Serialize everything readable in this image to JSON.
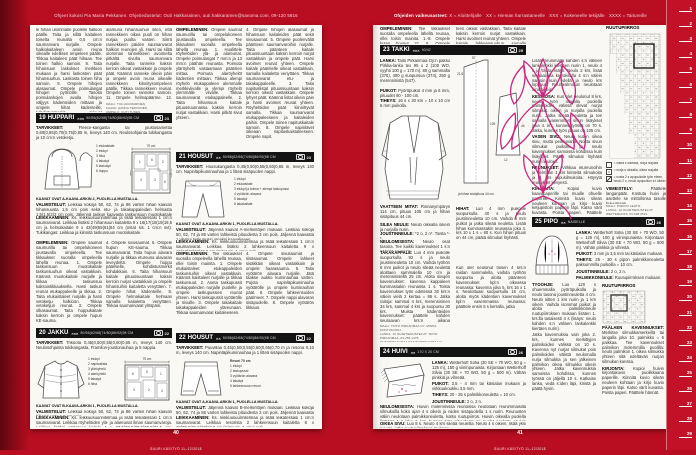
{
  "colors": {
    "bg": "#b90e21",
    "bar_bg": "#141414",
    "motif_pink": "#c9277e",
    "page": "#faf8f4"
  },
  "header_left": "Ohjeet kokosi Pia Maria Pekkanen. Ohjetiedustelut: Outi Hakkarainen, outi.hakkarainen@sanoma.com, 09-120 5816",
  "header_right": {
    "prefix": "Ohjeiden vaikeusasteet:",
    "levels": [
      "X = Aloittelijalle",
      "XX = Hieman harrastaneelle",
      "XXX = Kokeneelle tekijälle",
      "XXXX = Taitureille"
    ]
  },
  "footer": {
    "left_num": "40",
    "right_num": "41",
    "magazine": "SUURI KÄSITYÖ 11–12/2018"
  },
  "ruler": {
    "unit_numbers": [
      "1",
      "2",
      "3",
      "4",
      "5",
      "6",
      "7",
      "8",
      "9",
      "10",
      "11",
      "12",
      "13",
      "14",
      "15",
      "16",
      "17",
      "18",
      "19",
      "20",
      "21",
      "22",
      "23",
      "24",
      "25",
      "26",
      "27",
      "28",
      "29"
    ]
  },
  "lp": {
    "tail": {
      "c1": "le hihan ulommalle puolelle halkion päälle. Taita ja silitä kaitaleen toiselta reunalta 0,5 cm:n saumanvara nurjalle. Ompele halkiokaitaleen avoin reuna oikealle edellisen ompeleen päälle. Tikkaa kaitaleen päät hihaan. Tee toinen halkio samoin. 8. Taita hihansuun laskokset merkkien mukaan ja harsi laskosten päät hihansuuhun. Laskosta toinen hiha samoin. 9. Ompele hihojen alasaumat. Ompele poimulangat hihojen pyöriöille. Tasoita poimulankojen avulla hihojen väljyys kädenteiden mittaan ja ompele hihat kädenteille, kohdistusmerkit tulevat kohdakkain. 10. Ompele sisempi ja alempi ranneke ylämunoista yhteen. Ompele sisemmän rannekkeen",
      "c2": "alareuna hihansuuhun siten, että rannekkeen oikea puoli on hihan nurjaa puolta vasten. Siirrä rannekkeen päiden saumanvarat halkion reunojen yli. Harsi tai silitä ulomman rannekkeen avoimelta pitkältä sivulta saumanvara nurjalle. Taita ranneke kaksin kerroin oikeat vastakkain ja ompele päät. Käännä ranneke oikein päin ja ompele avoin reuna oikealle rannekkeen kiinnitysompeleen päälle. Tikkaa rannekkeen reunat. Ompele toinen ranneke samoin. 11. Ompele helmapäärme. 12. Ompele napinlävet ja napit etuosaan, hihanhalkioihin ja rannekkeisiin.",
      "credits": [
        "MALLI: TIIA HUUMARINEN",
        "KAAVA: HANNA TERVONEN",
        "OMPELU: OUTI TUNEN"
      ],
      "c3_h": "OMPELEMINEN:",
      "c3": "Ompele saumat saumurilla tai ompelukoneen joustavalla ompeleella. Tee tikkaukset suoralla ompeleella lähellä reunaa. 1. Huolittele röyhelöiden ylä- ja alareunat. Ompele poimulangat 7 mm:n ja 13 mm:n päähän reunasta. Poimuta yläröyhelö vastaamaan pääntien mittaa. Poimuta alaröyhelöt kädentien mittaan. Tikkaa alempi röyhelö etukappaleen alemmalle merkkiviivalle ja ylempi röyhelö ylemmälle viivalle. Tikkaa saumanvarat etukappaleelle. 2. Taita hihansuun kaitale pituussuunnassa kaksin kerroin nurjat vastakkain. Harsi pitkät sivut yhteen.",
      "c4": "4. Ompele hihojen alasaumat ja hihansuun kaitaleiden päät sekä sivusaumat. 5. Ompele puolenväliä päänteen saumanvaroihin nurjalle. Taita päänteen kaitale pituussuuntaan kaksin kerroin nurjat vastakkain ja ompele päät. Harsi avoimet reunat yhteen. Ompele kaitale pääntielle oikeat vastakkain, samalla kaitaletta venyttäen. Tikkaa saumanvarat etu- ja takakappaleelle. 3. Taita napituslistat pituussuuntaan kaksin kerroin oikeat vastakkain. Ompele lyhyet päät. Käännä listat oikein päin ja harsi avoimet reunat yhteen. Röyhelöiden päät kiinnittyvät samalla. Tikkaa saumanvarat etukappaleeseen ja kaitaleiden päihin. Ompele toinen napituskaitale samoin. 8. Ompele napinlävet oikeaan napituskaistaleeseen. Ompele napit."
    },
    "p19": {
      "num": "19",
      "name": "HUPPARI",
      "stars": "×××",
      "sizes": "50/56(62/68(74/80(86/92(98 CM",
      "photo": "23",
      "tarv_h": "TARVIKKEET:",
      "tarv": "Fleece-kangasta tai joustosamettia 0,60(0,65(0,70(0,75(0,85 m, leveys 140 cm. Neulosohjainta tukikangasta ja 10 cm:n vetoketju.",
      "pieces": [
        "1 etukaistale",
        "2 etukpl",
        "3 hiha",
        "4 takakpl",
        "5 taskukpl",
        "6 huppu"
      ],
      "layout_label": "70 cm",
      "layout_nums": [
        "1",
        "5",
        "2",
        "4",
        "3",
        "6"
      ],
      "fabric": "kangas",
      "fold": "taite",
      "kaavat": "KAAVAT OVAT A-KAAVA-ARKIN 2, PUOLELLA MUSTALLA.",
      "valm_h": "VALMISTELUT:",
      "valm": "Leikkaa kokoja 50, 62, 74 ja 86 varten hihan kaavan hihansuusta 1,5 cm pois sekä etu- ja takakappaleiden helmasta 1,5(1,5(2(2 cm pois. Jäljennä taskun kaavasta taskunsuun muotokaitale omaksi kaavakseen.",
      "leik_h": "LEIKKAAMINEN:",
      "leik": "Ks. leikkuusuunnitelmaa ja lisää leikatessasi 1 cm:n saumanvarat. Leikkaa lisäksi 2 hihansuun kaitaletta 9 x 16(17(18(19(19,5 cm ja helmakaitale 9 x 43(49(55(61(64 cm (mitat sis. 1 cm:n svt). Tukikangas: Leikkaa ja kiinnitä taskunsuun muotokaitale.",
      "omp_h": "OMPELEMINEN:",
      "omp1": "Ompele saumat saumurilla tai ompelukoneen joustavalla ompeleella. Tee tikkaukset suoralla ompeleella lähellä reunaa. 1. Ompele taskunsuun muotokaitale taskunsuuhun oikeat vastakkain. Käännä muotokaitale nurjalle ja tikkaa taskunsuu kaksoistikkauksella. Harsi taskun reunat etukappaleelle ja tikkaa. 2. Taita etukaistaleet nurjalle ja harsi vetoketju halkioon. Tikkaa vetoketjun reunat. 3. Ompele olkasaumat. Taita huppukaitale kaksin kerroin ja ompele hupun KE-sauma.",
      "omp2": "4. Ompele sivusaumat. 5. Ompele hupun KE-sauma. Tikkaa saumanvarat. Taita hupun alavara nurjalle ja tikkaa etureuna alavaran leveydeltä. Ompele huppu pääntielle, kohdistusmerkit kohdakkain. 6. Taita hihansuun kaitale pituussuuntaan kaksin kerroin nurjat vastakkain ja ompele hihansuihin kaitaletta venyttäen. 7. Ompele hihat kädenteille. 8. Ompele helmakaitale helmaan samalla kaitaletta venyttäen. Tikkaa saumanvarat ylöspäin."
    },
    "p20": {
      "num": "20",
      "name": "JAKKU",
      "stars": "×××",
      "sizes": "50/56(62/68(74/80(86/92(98 CM",
      "photo": "22",
      "tarv_h": "TARVIKKEET:",
      "tarv": "Trikoota 0,45(0,50(0,55(0,60(0,65 m, leveys 140 cm. Neulosohjainta tukikangasta, Framilon-joustonauhaa ja 5 nappia.",
      "pieces": [
        "1 etukpl",
        "2 napituslista",
        "3 yläröyhelö",
        "4 alaröyhelö",
        "5 takakpl",
        "6 hiha"
      ],
      "layout_label": "70 cm",
      "layout_nums": [
        "6",
        "5",
        "1",
        "3",
        "2",
        "4"
      ],
      "kaavat": "KAAVAT OVAT B-KAAVA-ARKIN 1, PUOLELLA MUSTALLA.",
      "valm_h": "VALMISTELUT:",
      "valm": "Leikkaa kokoja 50, 62, 74 ja 86 varten hihan kaavan hihansuusta 1,5 cm pois.",
      "leik_h": "LEIKKAAMINEN:",
      "leik": "Ks. leikkuusuunnitelmaa ja lisää leikatessasi 1 cm:n saumanvarat. Leikkaa röyhelöiden ylä- ja alareunat ilman saumanvaroja. Leikkaa lisäksi päänteen kaitale 1 x 27,5(28,5(29,5(30,5(31,5 cm, helmakaitale 8 x 45(45(49(53(55 cm ja 2 hihansuun kaitaletta 7 x 14,5(15,5(16,5(17,5(18 cm (mitat sis. 1 cm:n svt). Tukikangas: Leikkaa ja kiinnitä napituslistan alavaraan."
    },
    "p21": {
      "num": "21",
      "name": "HOUSUT",
      "stars": "××",
      "sizes": "50/56(62/68(74/80(86/92(98 CM",
      "photo": "23",
      "tarv_h": "TARVIKKEET:",
      "tarv": "Housukangasta 0,45(0,50(0,55(0,60(0,65 m, leveys 140 cm. Napinläpikuminauhaa ja 1 litteä sisäpuolen nappi.",
      "pieces": [
        "1 etukpl",
        "2 etukaistale",
        "3 etukpl ja kulma + alempi taskupussi",
        "4 vyötärön alavara",
        "5 takakpl",
        "6 takakaitale"
      ],
      "kaavat": "KAAVAT OVAT A-KAAVA-ARKIN 1, PUOLELLA MUSTALLA.",
      "valm_h": "VALMISTELUT:",
      "valm": "Jäljennä kaavat A-merkintöjen mukaan. Leikkaa kokoja 50, 62, 74 ja 86 varten lahkeista pituudesta 3 cm pois. Jäljennä kaavasta 1 ylempi taskupussi omaksi kaavakseen.",
      "leik_h": "LEIKKAAMINEN:",
      "leik": "Ks. leikkuusuunnitelmaa ja lisää leikatessasi 1 cm:n saumanvarat. Leikkaa lisäksi 2 lahkeensuun kaitaletta 9 x 16(17(18(19(19,5 cm (mitat sis. 1 cm:n svt).",
      "omp_h": "OMPELEMINEN:",
      "omp1": "Tee tikkaukset suoralla ompeleella lähellä reunaa, ellei toisin mainita. 1. Ompele etukaistaleet etukappaleiden taskunsuihin oikeat vastakkain. Käännä kaistaleet nurjalle ja tikkaa taskunsuut. 2. Aseta taskupussit etukappaleiden nurjalle puolelle ja ompele taskupussien reunat yhteen. Harsi taskupussit vyötärölle ja sivuille. 3. Ompele takakaitale takakappaleiden yläreunaan. Tikkaa saumanvarat kaitaleeseen.",
      "omp2": "4. Ompele sivusaumat ja sisäsaumat. Ompele lahkeet sisäkkäin oikeat vastakkain ja ompele haarasauma. 5. Taita vyötärön alavara nurjalle. Jätä taakse aukko kuminauhaa varten. Pujota napinläpikuminauha vyötärölle ja ompele kuminauhan päät. 6. Ompele lahkeensuiden päärmeet. 7. Ompele nappi alavaran sisäpuolelle. 8. Ompele vyötärön tikkaus."
    },
    "p22": {
      "num": "22",
      "name": "HOUSUT",
      "stars": "××",
      "sizes": "50/56(62/68(74/80(86/92(98 CM",
      "photo": "22",
      "tarv_h": "TARVIKKEET:",
      "tarv": "Puuvillaa 0,45(0,50(0,55(0,60(0,65(0,70 m ja resoria 0,10 m, leveys 140 cm. Napinläpikuminauhaa ja 1 litteä sisäpuolen nappi.",
      "resori": "Resori 70 cm",
      "pieces": [
        "1 etukpl",
        "2 taskupussi",
        "3 vyötärön alavara",
        "4 takakpl",
        "5 lahkeensuun resori"
      ],
      "kaavat": "KAAVAT OVAT A-KAAVA-ARKIN 1, PUOLELLA MUSTALLA.",
      "valm_h": "VALMISTELUT:",
      "valm": "Jäljennä kaavat B-merkintöjen mukaan. Leikkaa kokoja 50, 62, 74 ja 86 varten lahkeista pituudesta 3 cm pois. Jäljennä kaavasta 3 ulompi taskupussi omaksi kaavakseen.",
      "leik_h": "LEIKKAAMINEN:",
      "leik": "Ks. leikkuusuunnitelmaa ja lisää leikatessasi 1 cm:n saumanvarat. Leikkaa resorista 2 lahkeensuun kaitaletta 8 x 19(20,5(21,5(23(24,5 cm (mitat sis. 1 cm:n svt)."
    }
  },
  "rp": {
    "tail": {
      "r1_h": "OMPELEMINEN:",
      "r1": "Tee tikkaukset suoralla ompeleella lähellä reunaa, ellei toisin mainita. 1.-8. Ompele kuten housut 21. 9. Ompele lahkeensuun kaitaleen lyhyet päät yh-",
      "r2": "teen oikeat vastakkain. Taita kaitale kaksin kerroin nurjat vastakkain. Harsi avoimet reunat yhteen. Ompele kaitale lahkeensuuhun samalla kaitaletta venyttäen. Tee toinen lahkeensuu samoin."
    },
    "p23": {
      "num": "23",
      "name": "TAKKI",
      "stars": "×××",
      "sizes": "40/42",
      "photo": "25",
      "lanka_h": "LANKA:",
      "lanka": "Taito Pirkanmaa Oy:n paksu Pirkka-lanka tex 95 x 2 (100 WO, vyyhti 100 g = 170 m). 80 g sammalta (375), 400 g suopursua (374), 250 g merensinistä (547).",
      "puikot_h": "PUIKOT:",
      "puikot": "Pyöröpuikot 4 mm ja 6 mm, pituudet 80 - 100 cm.",
      "tiheys_h": "TIHEYS:",
      "tiheys": "16 s x 20 krs = 10 x 10 cm 6 mm puikolla.",
      "mitat_h": "VAATTEEN MITAT:",
      "mitat": "Rinnanympärys 114 cm, pituus 105 cm ja hihan sisäpituus 44 cm.",
      "silea_h": "SILEÄ NEULE:",
      "silea": "Neulo oikealla oikein ja nurjalla nurin.",
      "joustin_h": "JOUSTINNEULE:",
      "joustin": "*2 o, 2 n*. Toista *-*.",
      "neulom_h": "NEULOMISESTA:",
      "neulom": "Neulo osat tasona. Tee kaikki kavennukset 1 s:n päässä reunasta.",
      "taka_h": "TAKAKAPPALE:",
      "taka": "Luo 4 mm puikolle suopursulla 92 s ja neulo joustinneuletta 10 cm. Vaihda työhön 6 mm puikot ja neulo sileää neulettä aloittaen sammalella 10 cm ja merensinisellä 25 cm. Aloita sivujen kavennukset: kavenna kappaleen kummassakin reunassa 1 s. Toista kavennukset työn edetessä 30 krs:n välein vielä 2 kertaa = 86 s. Jatka raitoja: sammal 4 krs, merensininen 34 krs, sammal 4 krs ja suopursu 30 krs. Muista kädenteiden kavennukset: päättele kahden seuraavan krs:n aikana kummassakin reunassa 5 s = 76 s, sitten joka 4. krs 3 x 1 s = 70 s ja lopuksi 1 s joka 2. krs, kunnes jäljellä on 32 s. Päätä nämä takapäänteen s:t apulangalle.",
      "hihat_h": "HIHAT:",
      "hihat": "Luo 4 mm puikoille suopursulla 40 s ja neulo joustinneuletta 10 cm. Vaihda 6 mm puikot ja jatka sileää neuletta. Lisää hihan kummassakin reunassa joka 4. krs 10 x 1 s = 60 s. Kun hihan pituus on 44 cm, päätä silmukat löyhästi.",
      "jatko": "Kun olet neulonut toisen 4 krs:n raidan sammalella, vaihda työhön suopursu ja aloita päänteen kavennukset kpl:n oikeassa reunassa: kavenna joka 5. krs 16 x 1 s. Neulottuasi suopursulla 16 cm, aloita myös kädentien kavennukset kpl:n vasemmassa reunassa: päättele ensin 5 s kerralla, jatka",
      "credits": [
        "MALLI: TAITO PIRKANMAA OY, MINNA KONTUKOSKI.",
        "LANKA- JA OHJETIEDUSTELUT: TAITO PIRKANMAA, 03-255 1475, TAITOPIRKANMAA@TAITOPIRKANMAA.FI, WWW.TAITOPIRKANMAA.FI"
      ],
      "caption": "ja hihan sisäpituus 44 cm.",
      "meas": [
        "57",
        "105",
        "21,5",
        "44",
        "12"
      ],
      "intro": "Lisää neulomalla kahden s:n välinen lankalenkki kiertäen nurin 1, neulo 4 s ja toista lisäys. Neulo 2 krs, lisää seuraavalla kerroksella 4 s:n välein samoin kuin edellä ja neulo krs loppuun. Reunasilmukat neulotaan aina oikein.",
      "kesk_h": "KESKIOSA:",
      "kesk": "Kun olet neulonut 8 krs, neulo työn oikealla puolella palmikoiden välissä olevat nurjat silmukat oikein ja nurjalla puolella nurin. Jatka sileää neuletta ja tee samalla vasemman sivun lisäykset joka 4. krs, kunnes työssä on 70 s. Jatka, kunnes työn pituus on 105 cm.",
      "vasen_h": "VASEN SIVU:",
      "vasen": "Neulo kuten oikea sivu, mutta peilikuvana. Nosta sivun silmukat puikolle ja neulo kavennukset samoissa kohdissa kuin lisäykset. Päätä silmukat löyhästi nurin neuloen.",
      "reun_h": "REUNUKSET:",
      "reun": "Virkkaa etureunoihin ja helmaan 1 krs kiinteitä silmukoita ja 1 krs rapusilmukoita. Höyrytä reunukset kevyesti.",
      "kirj_h": "KIRJONTA:",
      "kirj": "Kopioi kuvio kaavapaperille tai muulle ohuelle paperille. Kiinnitä kuvio sileän neuleen kohtaan ja kirjo kuvio ketjupistoin paperin läpi. Katso värit kuvasta. Poista paperi. Päättele hännät."
    },
    "chart": {
      "title": "RUUTUPIIRROS",
      "legend": [
        "= oikea s oikealla, nurja nurjalla",
        "= nurja s oikealla, oikea nurjalla",
        "= nosta 2 s apupuikolle työn eteen, neulo 2 o, neulo apupuikon s:t oikein"
      ],
      "viim_h": "VIIMEISTELY:",
      "viim": "Päättele langanpäät. Kostuta huivi ja asettele se mittoihinsa tasolle kuivumaan.",
      "credits": [
        "MALLI: PIRKKO LEHTO.",
        "LANKA- JA OHJETIEDUSTELUT: WETTERHOFF, 03-628 2521."
      ]
    },
    "p24": {
      "num": "24",
      "name": "HUIVI",
      "stars": "××",
      "sizes": "170 X 20 CM",
      "photo": "26",
      "lanka_h": "LANKA:",
      "lanka": "Wetterhoff Sofia (30 SE + 70 WO, 50 g = 125 m), 150 g viininpunaista. Kirjontaan Wetterhoff Silvia (30 SE + 70 WO, 50 g = 500 m). Vähän pinkkiä ja vihreää.",
      "puikot_h": "PUIKOT:",
      "puikot": "3,5 - 4 mm tai käsialan mukaan ja virkkuukoukku 3,5 mm.",
      "tiheys_h": "TIHEYS:",
      "tiheys": "20 - 25 s palmikkoneuletta = 10 cm.",
      "joustin_h": "JOUSTINNEULE:",
      "joustin": "2 o, 2 n.",
      "neulom_h": "NEULOMISESTA:",
      "neulom": "Huivin molemmissa reunoissa neulotaan reunimmaisilla silmukoilla koko ajan 4 s oikein ja niiden sisäpuolella 1 s nurin. Reunusten väliin neulotaan palmikkoneuletta, katso ruutupiirros. Huivin oikealla puolella lisätään 1 s joka 4. krs, kunnes työn pituudesta on puolet neulottu. Huivin keskelle neulotaan n. 8 cm sileää neuletta, johon kirjaillaan kuvio. Sen jälkeen kavennetaan 1 s, joka 4. krs samoissa kohdissa kuin lisäykset tehtiin.",
      "oikea_h": "OIKEA SIVU:",
      "oikea": "Luo 8 s. Neulo 4 krs sileää neuletta. Neulo 4 s oikein, lisää yksi s nurin, jatka ruutupiirroksen mukaan."
    },
    "p25": {
      "num": "25",
      "name": "PIPO",
      "stars": "××",
      "sizes": "NAISELLE",
      "photo": "26",
      "lanka_h": "LANKA:",
      "lanka": "Wetterhoff Sofia (30 SE + 70 WO, 50 g = 125 m), 100 g viininpunaista. Kirjontaan Wetterhoff Silvia (30 SE + 70 WO, 50 g = 500 m). Vähän pinkkiä ja vihreää.",
      "puikot_h": "PUIKOT:",
      "puikot": "3 mm ja 3,5 mm tai käsialan mukaan.",
      "tiheys_h": "TIHEYS:",
      "tiheys": "25 - 30 s pipon palmikkoneuletta paksummilla puikoilla = 10 cm.",
      "joustin_h": "JOUSTINNEULE:",
      "joustin": "2 o, 2 n.",
      "palm_h": "PALMIKKONEULE:",
      "palm": "Ruutupiirroksen mukaan.",
      "tyo_h": "TYÖOHJE:",
      "tyo": "Luo 120 s ohuemmalla pyöröpuikolla ja neulo tasona joustinneuletta 4 cm. Neulo sitten 1 krs nurin ja 1 krs oikein. Vaihda isommat puikot ja aloita palmikkoneule ruutupiirroksen mukaan lisäten 1. krs:lla tasaisesti 4 s (lisäys: neulo kahden s:n välinen lankalenkki kiertäen nurin).",
      "cont": "Jatka kavennuksia vain joka 2. krs, kunnes merkittyjen palmikoiden välissä on 10 s. Kavenna nyt nurjat silmukat pois palmikoiden välistä neulomalla nurja silmukka ja sen jälkeinen palmikon oikea silmukka oikein yhteen. Jatka kavennuksia samoissa kohdissa, kunnes työssä on jäljellä 10 s. Katkaise lanka, vedä s:iden läpi, kiristä ja päätä hyvin.",
      "chart_title": "RUUTUPIIRROS",
      "paal_h": "PÄÄLAEN KAVENNUKSET:",
      "paal": "Merkitse silmukkamerkeillä tai langalla joka 10. palmikko = 6 paikkaa. Tee kavennukset palmikon molemmilla puolilla: neulo palmikon 1. oikea silmukka yhteen sitä edeltävän nurjan silmukan kanssa.",
      "kirj_h": "KIRJONTA:",
      "kirj": "Kopioi huivin kirjontakuvio puolikkaana paperille. Kiinnitä kuvio sileän neuleen kohtaan ja kirjo kuvio paperin läpi. Katso värit kuvasta. Poista paperi. Päättele hännät."
    }
  }
}
